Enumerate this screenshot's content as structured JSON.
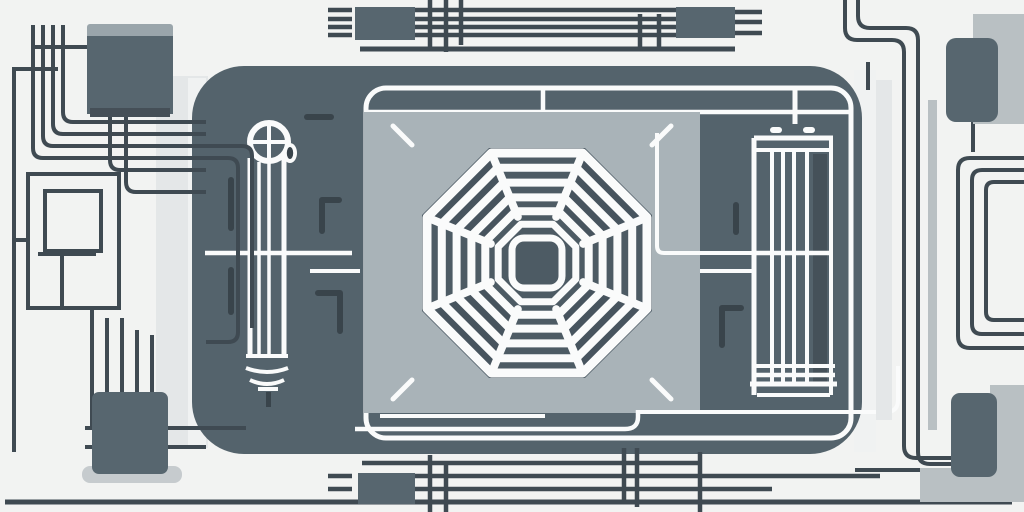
{
  "meta": {
    "alt": "Stylized flat illustration of an electronic hardware module (circuit-board style device) with a central octagonal fan grille, a capacitor tube on the left, a heatsink battery block on the right, connector chips in the corners, and bus traces running along the top, bottom, left and right margins."
  },
  "colors": {
    "background": "#f2f3f2",
    "body": "#54636c",
    "panel": "#a9b3b8",
    "grille": "#4d5b64",
    "grille_shade": "#47545e",
    "white": "#fafbfb",
    "trace": "#3f4a52",
    "mark": "#39444b",
    "chip": "#57666f",
    "chip_cap": "#9aa5ab",
    "chip_edge": "#454f57",
    "light_band": "#e4e7e8",
    "light_band_bright": "#f0f2f2",
    "light_bar": "#b9c0c3",
    "shadow": "#c6cbce"
  }
}
